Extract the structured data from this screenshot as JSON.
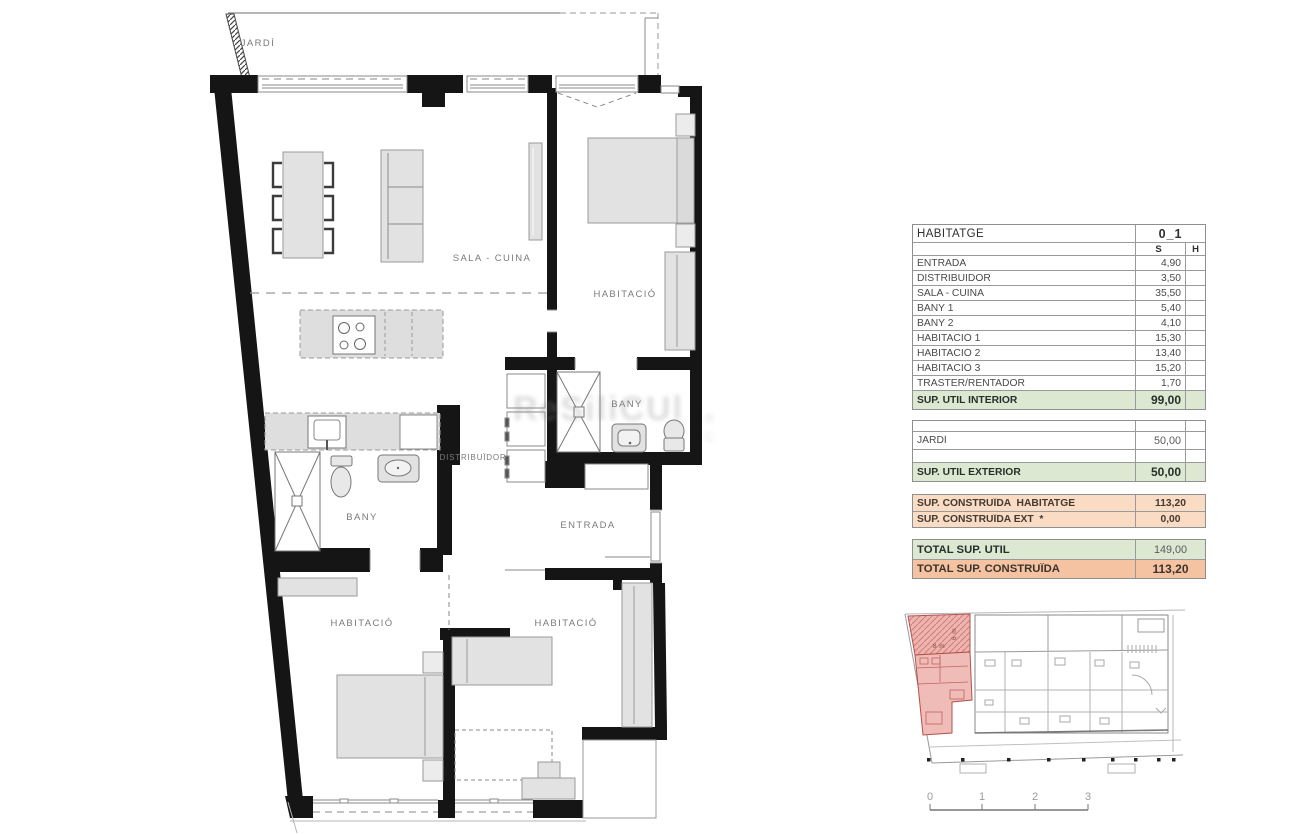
{
  "plan": {
    "labels": {
      "jardi": "JARDÍ",
      "sala_cuina": "SALA - CUINA",
      "habitacio_top": "HABITACIÓ",
      "bany_right": "BANY",
      "distribuidor": "DISTRIBUÏDOR",
      "bany_left": "BANY",
      "entrada": "ENTRADA",
      "habitacio_bottom_left": "HABITACIÓ",
      "habitacio_bottom_right": "HABITACIÓ"
    }
  },
  "table": {
    "title": "HABITATGE",
    "unit_id": "0_1",
    "columns": {
      "s": "S",
      "h": "H"
    },
    "rooms": [
      {
        "label": "ENTRADA",
        "s": "4,90"
      },
      {
        "label": "DISTRIBUIDOR",
        "s": "3,50"
      },
      {
        "label": "SALA - CUINA",
        "s": "35,50"
      },
      {
        "label": "BANY 1",
        "s": "5,40"
      },
      {
        "label": "BANY 2",
        "s": "4,10"
      },
      {
        "label": "HABITACIÓ 1",
        "s": "15,30"
      },
      {
        "label": "HABITACIÓ 2",
        "s": "13,40"
      },
      {
        "label": "HABITACIÓ 3",
        "s": "15,20"
      },
      {
        "label": "TRASTER/RENTADOR",
        "s": "1,70"
      }
    ],
    "sup_util_interior": {
      "label": "SUP. UTIL INTERIOR",
      "value": "99,00"
    },
    "exterior": {
      "jardi": {
        "label": "JARDÍ",
        "value": "50,00"
      },
      "total": {
        "label": "SUP. UTIL EXTERIOR",
        "value": "50,00"
      }
    },
    "construida": {
      "habitatge": {
        "label": "SUP. CONSTRUÏDA  HABITATGE",
        "value": "113,20"
      },
      "ext": {
        "label": "SUP. CONSTRUÏDA EXT  *",
        "value": "0,00"
      }
    },
    "totals": {
      "util": {
        "label": "TOTAL SUP. UTIL",
        "value": "149,00"
      },
      "construida": {
        "label": "TOTAL SUP. CONSTRUÏDA",
        "value": "113,20"
      }
    }
  },
  "keyplan": {
    "dim_width": "8 m",
    "dim_depth": "6 m",
    "scale": [
      "0",
      "1",
      "2",
      "3"
    ]
  },
  "watermark": {
    "main": "ReSiliCUl",
    "side_top": "R",
    "side_bottom": "C"
  },
  "colors": {
    "wall": "#151515",
    "furniture_fill": "#e2e2e2",
    "green_row": "#dde8d3",
    "orange_row": "#fadbc3",
    "orange_total": "#f5c3a2",
    "red_unit_fill": "#eeb4af",
    "red_unit_line": "#b2504b"
  }
}
